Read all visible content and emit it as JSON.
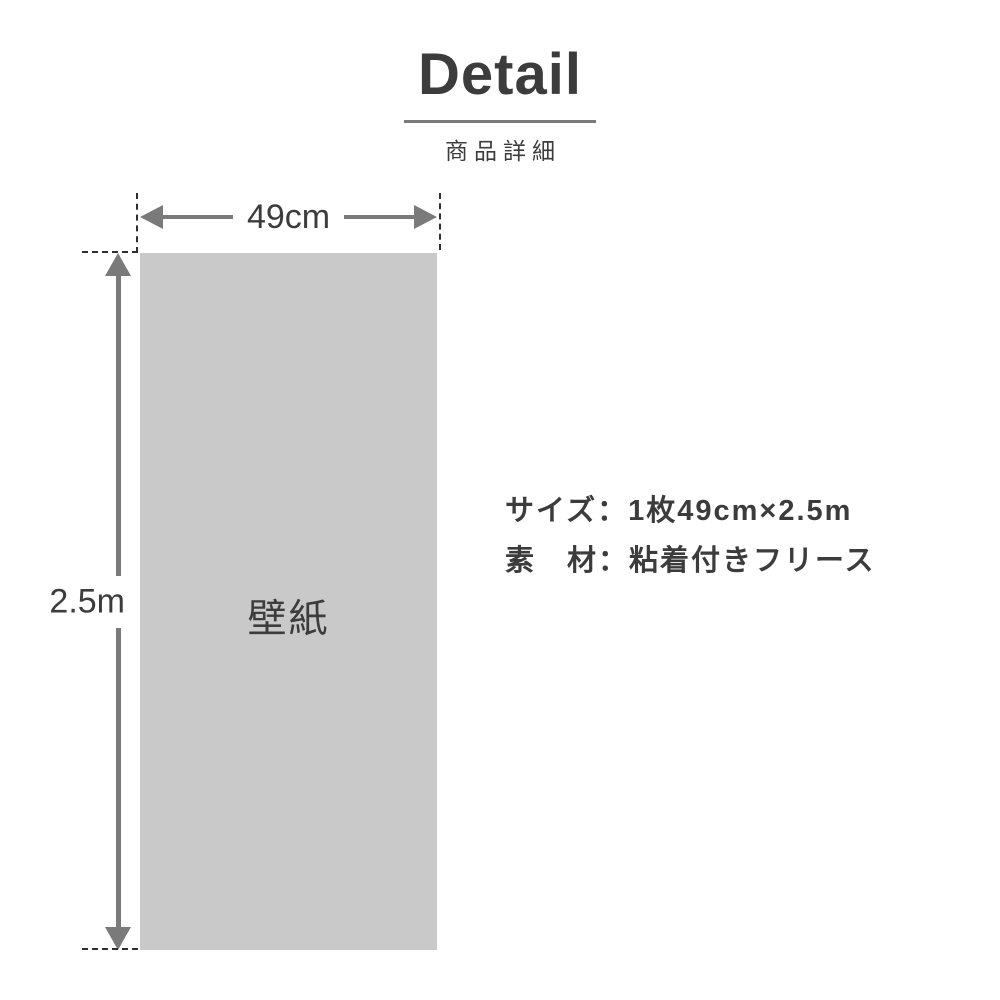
{
  "header": {
    "title": "Detail",
    "subtitle": "商品詳細"
  },
  "diagram": {
    "width_label": "49cm",
    "height_label": "2.5m",
    "panel_label": "壁紙"
  },
  "specs": {
    "size_line": "サイズ：1枚49cm×2.5m",
    "material_line": "素　材：粘着付きフリース"
  },
  "colors": {
    "ink": "#3c3c3c",
    "line": "#7a7a7a",
    "panel": "#c9c9c9",
    "dash": "#2f2f2f",
    "underline": "#7a7a7a",
    "bg": "#ffffff"
  }
}
